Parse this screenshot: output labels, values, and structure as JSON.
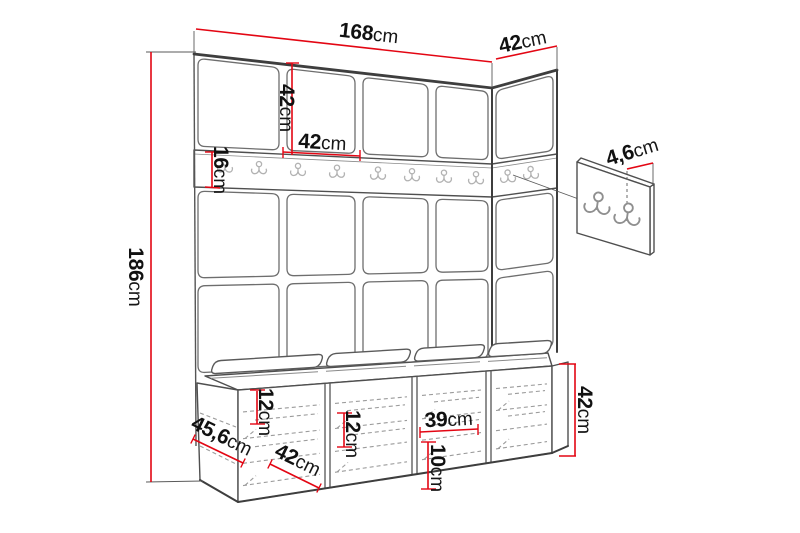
{
  "diagram": {
    "kind": "furniture-dimension-drawing",
    "unit": "cm",
    "rail_hook_count": 10,
    "wall_panel_hook_count": 2
  },
  "dimensions": {
    "width_total": {
      "value": "168",
      "unit": "cm"
    },
    "depth_top": {
      "value": "42",
      "unit": "cm"
    },
    "panel_height": {
      "value": "42",
      "unit": "cm"
    },
    "panel_width": {
      "value": "42",
      "unit": "cm"
    },
    "rail_height": {
      "value": "16",
      "unit": "cm"
    },
    "height_total": {
      "value": "186",
      "unit": "cm"
    },
    "hook_panel_thickness": {
      "value": "4,6",
      "unit": "cm"
    },
    "bench_opening_height_left": {
      "value": "12",
      "unit": "cm"
    },
    "bench_opening_height_mid": {
      "value": "12",
      "unit": "cm"
    },
    "bench_opening_width": {
      "value": "39",
      "unit": "cm"
    },
    "bench_opening_height_right": {
      "value": "10",
      "unit": "cm"
    },
    "bench_height": {
      "value": "42",
      "unit": "cm"
    },
    "bench_depth": {
      "value": "45,6",
      "unit": "cm"
    },
    "bench_seat_depth": {
      "value": "42",
      "unit": "cm"
    }
  },
  "colors": {
    "dimension_line": "#e30613",
    "drawing_line": "#4f4f4f",
    "text": "#111111",
    "background": "#ffffff"
  }
}
